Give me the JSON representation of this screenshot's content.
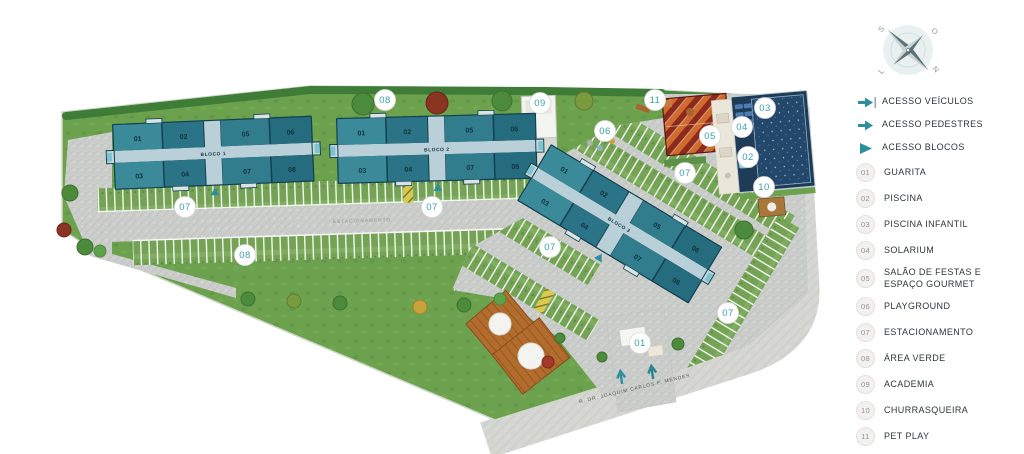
{
  "map": {
    "road_label": "ESTACIONAMENTO",
    "street_label": "R. DR. JOAQUIM CARLOS P. MENDES",
    "blocks": [
      {
        "name": "BLOCO 1",
        "top": [
          "01",
          "02",
          "05",
          "06"
        ],
        "bottom": [
          "03",
          "04",
          "07",
          "08"
        ]
      },
      {
        "name": "BLOCO 2",
        "top": [
          "01",
          "02",
          "05",
          "06"
        ],
        "bottom": [
          "03",
          "04",
          "07",
          "08"
        ]
      },
      {
        "name": "BLOCO 3",
        "top": [
          "01",
          "02",
          "05",
          "06"
        ],
        "bottom": [
          "03",
          "04",
          "07",
          "08"
        ]
      }
    ],
    "badges": [
      {
        "label": "08"
      },
      {
        "label": "09"
      },
      {
        "label": "11"
      },
      {
        "label": "06"
      },
      {
        "label": "05"
      },
      {
        "label": "03"
      },
      {
        "label": "04"
      },
      {
        "label": "02"
      },
      {
        "label": "10"
      },
      {
        "label": "07"
      },
      {
        "label": "07"
      },
      {
        "label": "07"
      },
      {
        "label": "07"
      },
      {
        "label": "07"
      },
      {
        "label": "08"
      },
      {
        "label": "01"
      }
    ]
  },
  "compass": {
    "top_left": "S",
    "top_right": "O",
    "bottom_left": "L",
    "bottom_right": "N"
  },
  "legend": {
    "access": [
      {
        "icon": "vehicle-access-arrow",
        "label": "ACESSO VEÍCULOS"
      },
      {
        "icon": "pedestrian-access-arrow",
        "label": "ACESSO PEDESTRES"
      },
      {
        "icon": "block-access-triangle",
        "label": "ACESSO BLOCOS"
      }
    ],
    "items": [
      {
        "num": "01",
        "label": "GUARITA"
      },
      {
        "num": "02",
        "label": "PISCINA"
      },
      {
        "num": "03",
        "label": "PISCINA INFANTIL"
      },
      {
        "num": "04",
        "label": "SOLARIUM"
      },
      {
        "num": "05",
        "label": "SALÃO DE FESTAS E ESPAÇO GOURMET"
      },
      {
        "num": "06",
        "label": "PLAYGROUND"
      },
      {
        "num": "07",
        "label": "ESTACIONAMENTO"
      },
      {
        "num": "08",
        "label": "ÁREA VERDE"
      },
      {
        "num": "09",
        "label": "ACADEMIA"
      },
      {
        "num": "10",
        "label": "CHURRASQUEIRA"
      },
      {
        "num": "11",
        "label": "PET PLAY"
      }
    ]
  },
  "colors": {
    "teal_accent": "#2E8F9C",
    "building_light": "#3A8A99",
    "building_dark": "#256C7E",
    "pool_navy": "#1E3C58",
    "grass": "#6CA14E",
    "roof_red": "#8C2B1D",
    "roof_orange": "#D06A2E"
  }
}
